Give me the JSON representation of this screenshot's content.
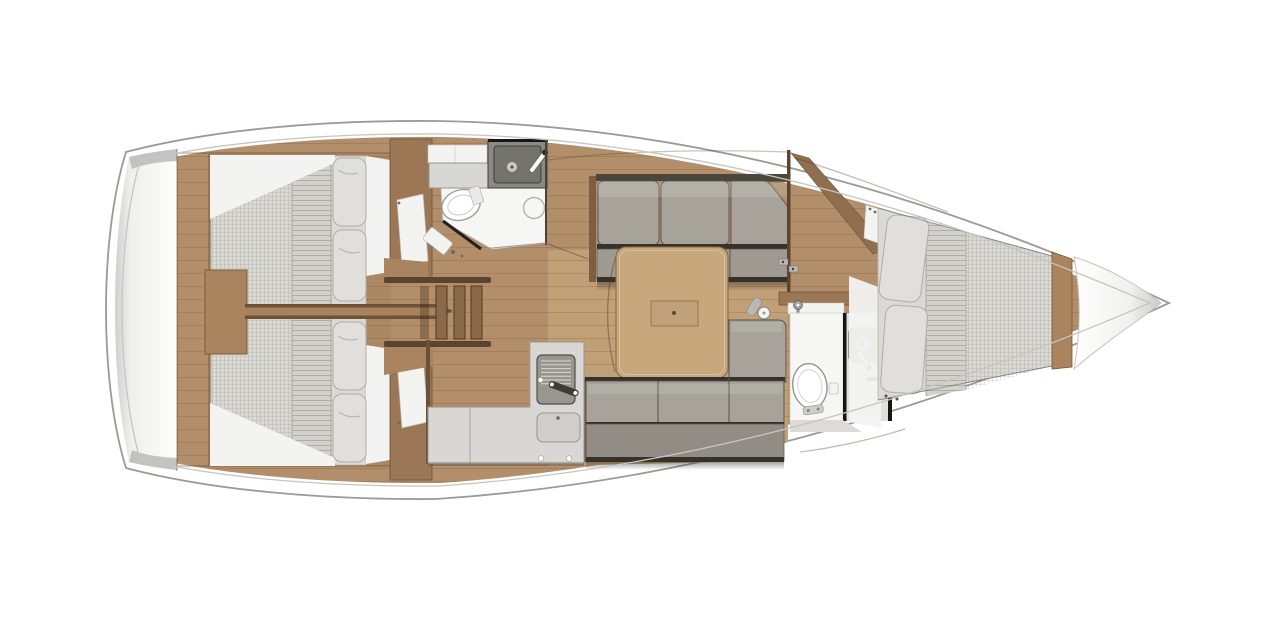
{
  "page": {
    "background": "#ffffff",
    "description": "Top-down interior layout plan of a sailing yacht, bow pointing right, no text labels"
  },
  "vessel": {
    "type": "sailing-yacht interior floor plan",
    "orientation": "bow-right",
    "rooms": [
      {
        "id": "stern-platform",
        "name": "transom / swim platform",
        "furniture": []
      },
      {
        "id": "aft-cabin-port",
        "name": "aft double cabin (top)",
        "furniture": [
          "double berth with quilted mattress",
          "two pillows"
        ]
      },
      {
        "id": "aft-cabin-starboard",
        "name": "aft double cabin (bottom)",
        "furniture": [
          "double berth with quilted mattress",
          "two pillows"
        ]
      },
      {
        "id": "companionway",
        "name": "companionway steps",
        "furniture": [
          "ladder with three treads"
        ]
      },
      {
        "id": "aft-head",
        "name": "aft head (bathroom)",
        "furniture": [
          "toilet",
          "sink unit with faucet",
          "shower drain",
          "counter",
          "cabinet"
        ]
      },
      {
        "id": "galley",
        "name": "L-shaped galley",
        "furniture": [
          "two-burner stove with handle",
          "sink",
          "counter with knobs",
          "fridge"
        ]
      },
      {
        "id": "saloon",
        "name": "saloon",
        "furniture": [
          "port settee with three cushions",
          "starboard settee with three cushions and corner return",
          "dining table with folding leaf",
          "handrail post"
        ]
      },
      {
        "id": "forward-head",
        "name": "forward head (bathroom)",
        "furniture": [
          "toilet",
          "vanity sink with faucet",
          "shower fixture",
          "toilet-paper holder"
        ]
      },
      {
        "id": "forward-cabin",
        "name": "forward V-berth cabin",
        "furniture": [
          "double V-berth",
          "two pillows",
          "cabin door"
        ]
      },
      {
        "id": "bow-locker",
        "name": "anchor locker",
        "furniture": []
      }
    ]
  },
  "colors": {
    "page_bg": "#ffffff",
    "hull_fill": "#ffffff",
    "hull_stroke": "#9a9a98",
    "hull_inner_stroke": "#c6c5c2",
    "deck_wood": "#b28e6a",
    "plank_line": "#654526",
    "salon_sole": "#c2a077",
    "table_wood": "#c8a77d",
    "wood_trim": "#a9845f",
    "wood_dark": "#9b7755",
    "wood_edge": "#6d5237",
    "wood_divider": "#a8835f",
    "mattress": "#dad9d4",
    "quilt": "#d2d1cc",
    "pillow": "#e0dfdb",
    "pillow_edge": "#aeada9",
    "cushion": "#a7a39a",
    "cushion_seat": "#9e9a91",
    "cushion_back": "#918d84",
    "seam_dark": "#36322b",
    "counter": "#d8d7d3",
    "counter_edge": "#97968f",
    "appliance": "#97978f",
    "appliance_dark": "#7f7f78",
    "bath_floor": "#f6f6f4",
    "alcove_floor": "#e0dfdc",
    "white_piece": "#f3f3f1",
    "fixture_white": "#ffffff",
    "fixture_edge": "#97968f",
    "wall_black": "#161613",
    "metal_gray": "#8f8f8b"
  }
}
